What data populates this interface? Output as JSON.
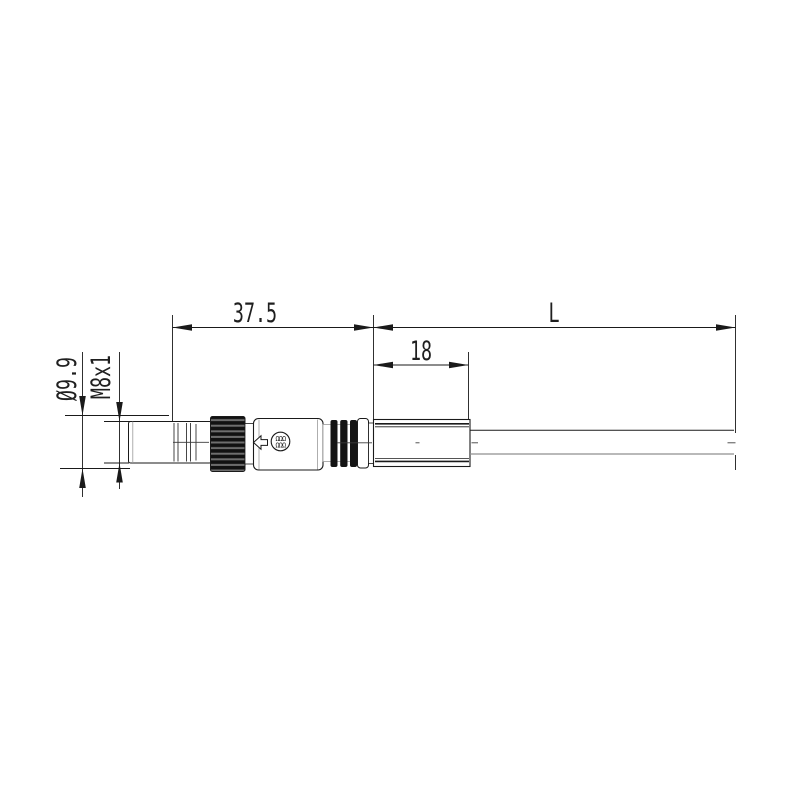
{
  "page": {
    "background": "#ffffff"
  },
  "colors": {
    "line": "#1a1a1a",
    "text": "#1f1f1f",
    "gray_line": "#8f8f8f",
    "detail_gray": "#9a9a9a",
    "center_line": "#3a3a3a",
    "knurl_dark": "#111111",
    "knurl_stripe": "#6e6e6e",
    "rib_dark": "#141414"
  },
  "dimensions": {
    "connector_length": {
      "label": "37.5"
    },
    "cable_length": {
      "label": "L"
    },
    "boot_length": {
      "label": "18"
    },
    "outer_diameter": {
      "label": "Ø9.9"
    },
    "thread_size": {
      "label": "M8x1"
    }
  },
  "logo": {
    "row1": "ΩΩΩ",
    "row2": "ΩΩΩ"
  }
}
